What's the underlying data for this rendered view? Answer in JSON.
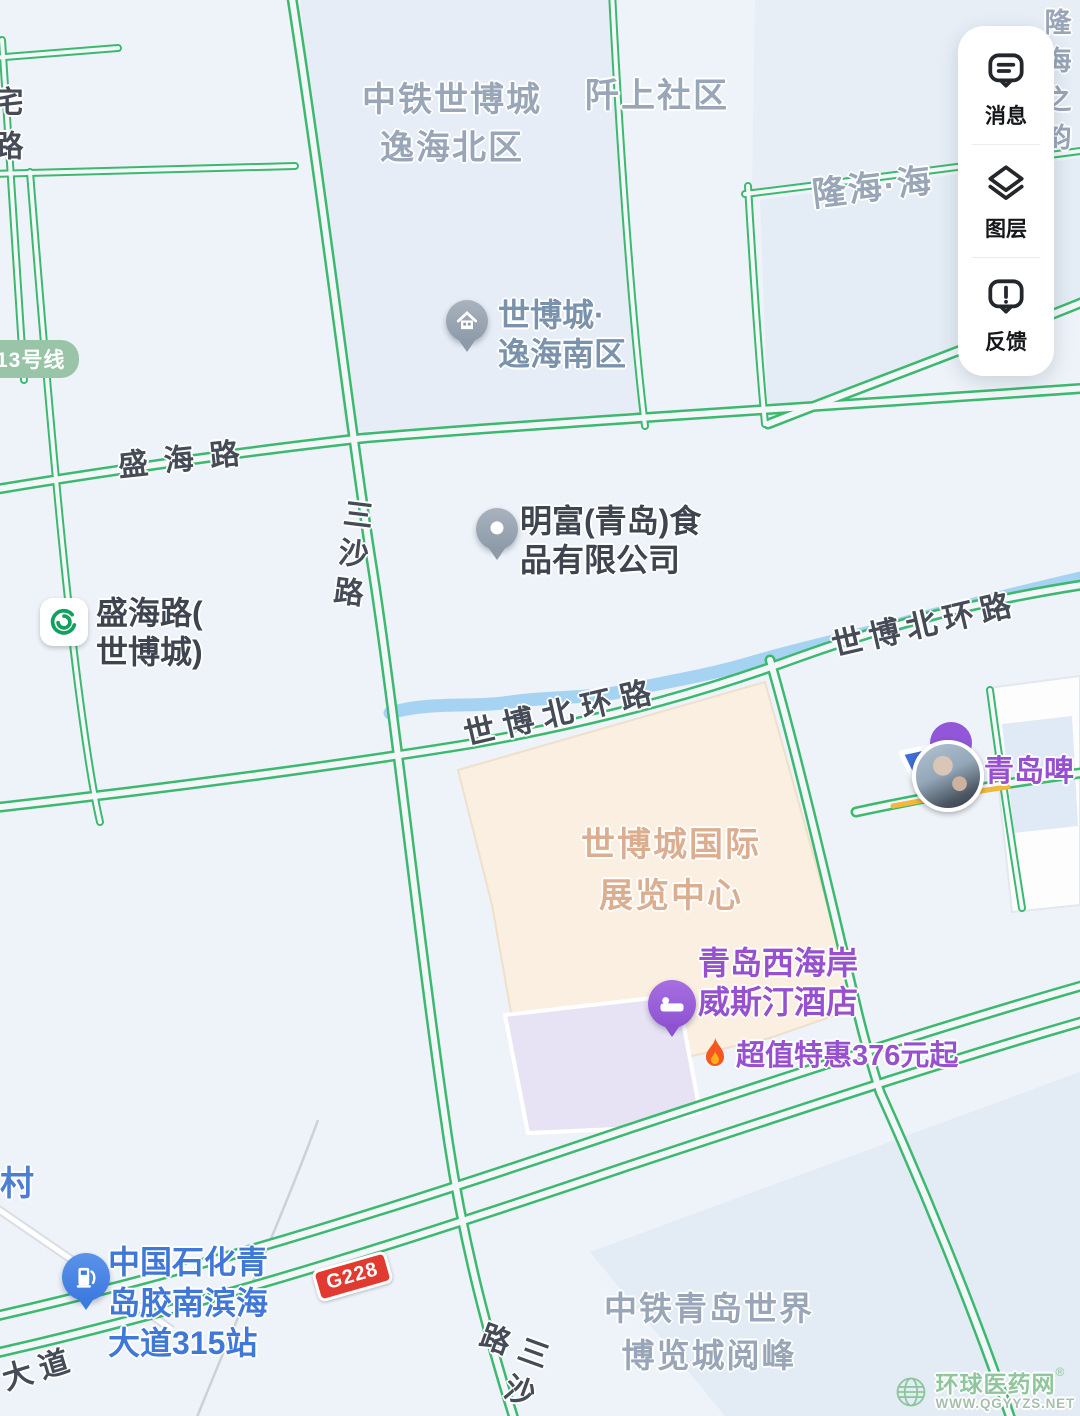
{
  "panel": {
    "items": [
      {
        "label": "消息"
      },
      {
        "label": "图层"
      },
      {
        "label": "反馈"
      }
    ]
  },
  "areas": {
    "zhongtie_north": "中铁世博城\n逸海北区",
    "qianshang": "阡上社区",
    "longhai": "隆海·海",
    "longhai_corner": "隆海\n之韵",
    "expo_center": "世博城国际\n展览中心",
    "yuefeng": "中铁青岛世界\n博览城阅峰",
    "village": "村"
  },
  "roads": {
    "shenghai": "盛海路",
    "sansha": "三沙路",
    "shibo_north_a": "世博北环路",
    "shibo_north_b": "世博北环路",
    "sansha_south": "三沙路",
    "dadao": "大道",
    "left_edge": "宅路"
  },
  "badges": {
    "metro_line": "13号线",
    "highway": "G228"
  },
  "pois": {
    "yihai_south": {
      "name": "世博城·\n逸海南区"
    },
    "mingfu": {
      "name": "明富(青岛)食\n品有限公司"
    },
    "metro_station": {
      "name": "盛海路(\n世博城)"
    },
    "beer": {
      "name": "青岛啤"
    },
    "westin": {
      "name": "青岛西海岸\n威斯汀酒店",
      "promo": "超值特惠376元起"
    },
    "gas": {
      "name": "中国石化青\n岛胶南滨海\n大道315站"
    }
  },
  "watermark": {
    "title": "环球医药网",
    "reg": "®",
    "url": "WWW.QGYYZS.NET"
  },
  "colors": {
    "road_green": "#3cb96f",
    "river_blue": "#a7d3f3",
    "poi_purple": "#9751cf",
    "poi_blue": "#3d7ae0",
    "expo_beige": "#faefe0",
    "highway_badge_red": "#e03a31"
  }
}
